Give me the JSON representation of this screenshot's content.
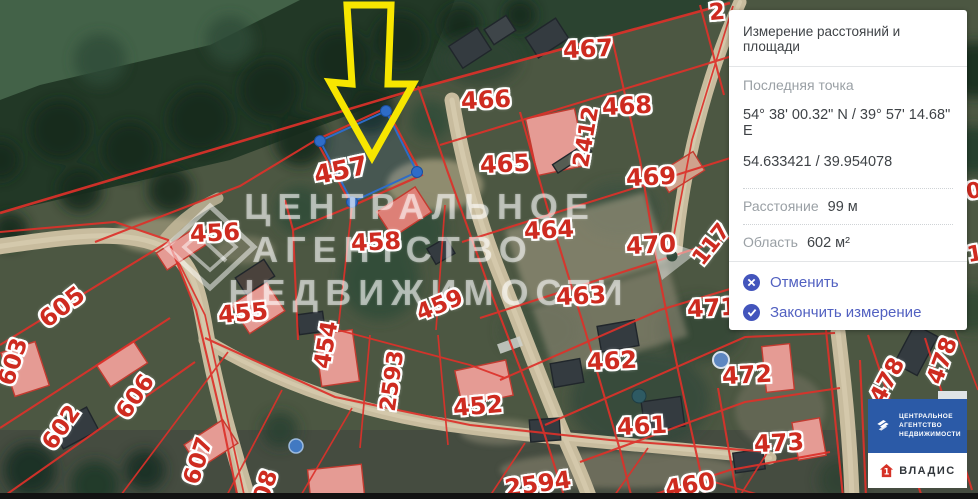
{
  "panel": {
    "title": "Измерение расстояний и площади",
    "last_point_label": "Последняя точка",
    "coords_dms": "54° 38' 00.32\" N / 39° 57' 14.68\" E",
    "coords_decimal": "54.633421 / 39.954078",
    "distance_label": "Расстояние",
    "distance_value": "99 м",
    "area_label": "Область",
    "area_value": "602 м²",
    "cancel_label": "Отменить",
    "finish_label": "Закончить измерение",
    "accent_color": "#4355bc"
  },
  "map": {
    "watermark": {
      "line1": "ЦЕНТРАЛЬНОЕ",
      "line2": "АГЕНТСТВО",
      "line3": "НЕДВИЖИМОСТИ"
    },
    "measurement": {
      "vertices": [
        [
          320,
          141
        ],
        [
          386,
          111
        ],
        [
          417,
          172
        ],
        [
          352,
          202
        ]
      ],
      "color": "#2e6cc8",
      "fill": "rgba(46,95,180,0.14)"
    },
    "arrow_color": "#f7e600",
    "cadastral_line_color": "#dd312a",
    "parcels": [
      {
        "t": "457",
        "x": 341,
        "y": 171,
        "r": -12,
        "s": 26
      },
      {
        "t": "456",
        "x": 215,
        "y": 233,
        "r": -3,
        "s": 24
      },
      {
        "t": "458",
        "x": 376,
        "y": 242,
        "r": -3,
        "s": 24
      },
      {
        "t": "455",
        "x": 243,
        "y": 313,
        "r": -5,
        "s": 24
      },
      {
        "t": "454",
        "x": 327,
        "y": 345,
        "r": -80,
        "s": 23
      },
      {
        "t": "459",
        "x": 440,
        "y": 306,
        "r": -22,
        "s": 23
      },
      {
        "t": "2593",
        "x": 393,
        "y": 381,
        "r": -82,
        "s": 22
      },
      {
        "t": "452",
        "x": 478,
        "y": 406,
        "r": -5,
        "s": 24
      },
      {
        "t": "605",
        "x": 62,
        "y": 307,
        "r": -38,
        "s": 24
      },
      {
        "t": "603",
        "x": 14,
        "y": 362,
        "r": -72,
        "s": 23
      },
      {
        "t": "602",
        "x": 62,
        "y": 428,
        "r": -55,
        "s": 23
      },
      {
        "t": "606",
        "x": 136,
        "y": 397,
        "r": -55,
        "s": 23
      },
      {
        "t": "607",
        "x": 199,
        "y": 461,
        "r": -72,
        "s": 23
      },
      {
        "t": "608",
        "x": 264,
        "y": 494,
        "r": -72,
        "s": 23
      },
      {
        "t": "466",
        "x": 486,
        "y": 100,
        "r": -3,
        "s": 24
      },
      {
        "t": "467",
        "x": 588,
        "y": 49,
        "r": -3,
        "s": 24
      },
      {
        "t": "468",
        "x": 627,
        "y": 106,
        "r": -3,
        "s": 24
      },
      {
        "t": "2412",
        "x": 587,
        "y": 137,
        "r": -80,
        "s": 22
      },
      {
        "t": "465",
        "x": 505,
        "y": 164,
        "r": -3,
        "s": 24
      },
      {
        "t": "469",
        "x": 651,
        "y": 177,
        "r": -3,
        "s": 24
      },
      {
        "t": "464",
        "x": 549,
        "y": 230,
        "r": -3,
        "s": 24
      },
      {
        "t": "470",
        "x": 651,
        "y": 245,
        "r": -3,
        "s": 24
      },
      {
        "t": "117",
        "x": 712,
        "y": 245,
        "r": -52,
        "s": 22
      },
      {
        "t": "463",
        "x": 581,
        "y": 296,
        "r": -3,
        "s": 24
      },
      {
        "t": "471",
        "x": 712,
        "y": 308,
        "r": -3,
        "s": 24
      },
      {
        "t": "462",
        "x": 612,
        "y": 361,
        "r": -3,
        "s": 24
      },
      {
        "t": "472",
        "x": 747,
        "y": 375,
        "r": -3,
        "s": 24
      },
      {
        "t": "461",
        "x": 642,
        "y": 426,
        "r": -3,
        "s": 24
      },
      {
        "t": "473",
        "x": 779,
        "y": 443,
        "r": -3,
        "s": 24
      },
      {
        "t": "2594",
        "x": 538,
        "y": 484,
        "r": -8,
        "s": 24
      },
      {
        "t": "460",
        "x": 690,
        "y": 485,
        "r": -10,
        "s": 24
      },
      {
        "t": "478",
        "x": 888,
        "y": 381,
        "r": -62,
        "s": 23
      },
      {
        "t": "478",
        "x": 943,
        "y": 361,
        "r": -70,
        "s": 23
      },
      {
        "t": "2",
        "x": 717,
        "y": 13,
        "r": -5,
        "s": 23
      },
      {
        "t": "0",
        "x": 974,
        "y": 192,
        "r": -10,
        "s": 22
      },
      {
        "t": "1",
        "x": 975,
        "y": 255,
        "r": -10,
        "s": 22
      }
    ]
  },
  "badge": {
    "agency_lines": [
      "ЦЕНТРАЛЬНОЕ",
      "АГЕНТСТВО",
      "НЕДВИЖИМОСТИ"
    ],
    "agency_bg": "#2b5aa7",
    "partner_name": "ВЛАДИС"
  }
}
